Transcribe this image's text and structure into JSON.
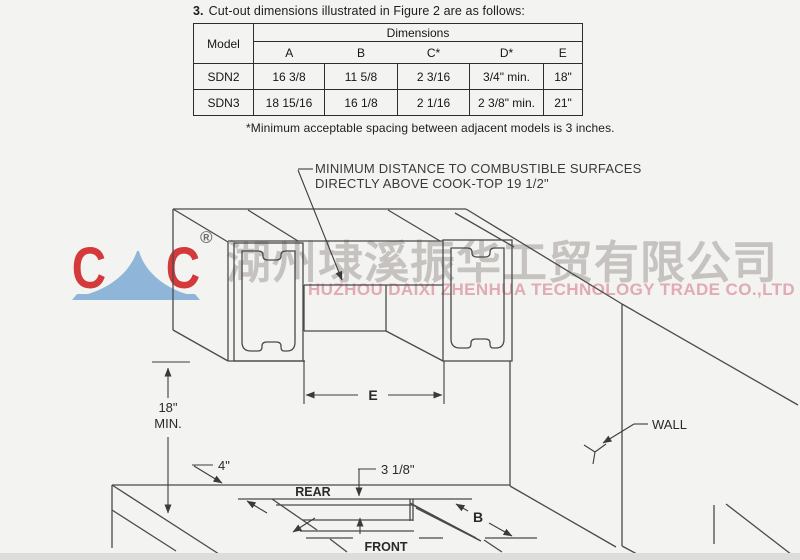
{
  "note": {
    "number": "3.",
    "text": "Cut-out dimensions illustrated in Figure 2 are as follows:"
  },
  "table": {
    "group_header": "Dimensions",
    "columns": [
      "Model",
      "A",
      "B",
      "C*",
      "D*",
      "E"
    ],
    "rows": [
      {
        "model": "SDN2",
        "a": "16 3/8",
        "b": "11 5/8",
        "c": "2 3/16",
        "d": "3/4\" min.",
        "e": "18\""
      },
      {
        "model": "SDN3",
        "a": "18 15/16",
        "b": "16 1/8",
        "c": "2 1/16",
        "d": "2 3/8\" min.",
        "e": "21\""
      }
    ],
    "footnote": "*Minimum acceptable spacing between adjacent models is 3 inches."
  },
  "watermark": {
    "logo_text_1": "C",
    "logo_text_2": "C",
    "registered": "®",
    "company_cn": "湖州埭溪振华工贸有限公司",
    "company_en": "HUZHOU DAIXI ZHENHUA TECHNOLOGY TRADE CO.,LTD",
    "colors": {
      "logo_red": "#d4393b",
      "logo_blue": "#8fb6d9",
      "text_pink": "#e0abb3",
      "text_gray": "#a7a3a1"
    }
  },
  "diagram": {
    "callout_line1": "MINIMUM DISTANCE TO COMBUSTIBLE SURFACES",
    "callout_line2": "DIRECTLY ABOVE COOK-TOP 19 1/2\"",
    "labels": {
      "e": "E",
      "b": "B",
      "height": "18\"",
      "height_min": "MIN.",
      "left_offset": "4\"",
      "rear_offset": "3 1/8\"",
      "rear": "REAR",
      "front": "FRONT",
      "wall": "WALL"
    }
  }
}
